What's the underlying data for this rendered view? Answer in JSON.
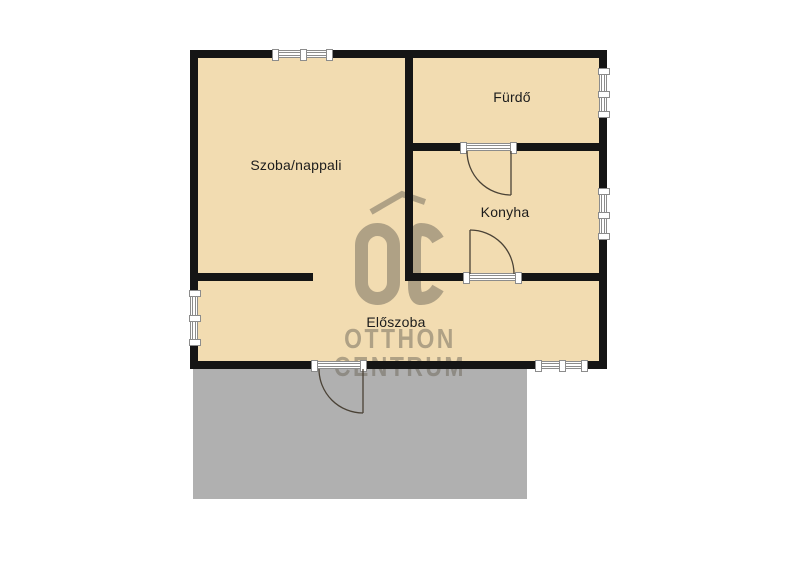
{
  "rooms": {
    "szoba": {
      "label": "Szoba/nappali"
    },
    "furdo": {
      "label": "Fürdő"
    },
    "konyha": {
      "label": "Konyha"
    },
    "eloszoba": {
      "label": "Előszoba"
    }
  },
  "watermark": {
    "logo_text": "OC",
    "line1": "OTTHON",
    "line2": "CENTRUM"
  },
  "colors": {
    "background": "#ffffff",
    "floor": "#f2dcb1",
    "terrace": "#b0b0b0",
    "wall": "#151515",
    "window_fill": "#ffffff",
    "window_line": "#8c8c8c",
    "door_line": "#4a4236",
    "label": "#1c1c1c",
    "watermark": "#6e675a"
  }
}
